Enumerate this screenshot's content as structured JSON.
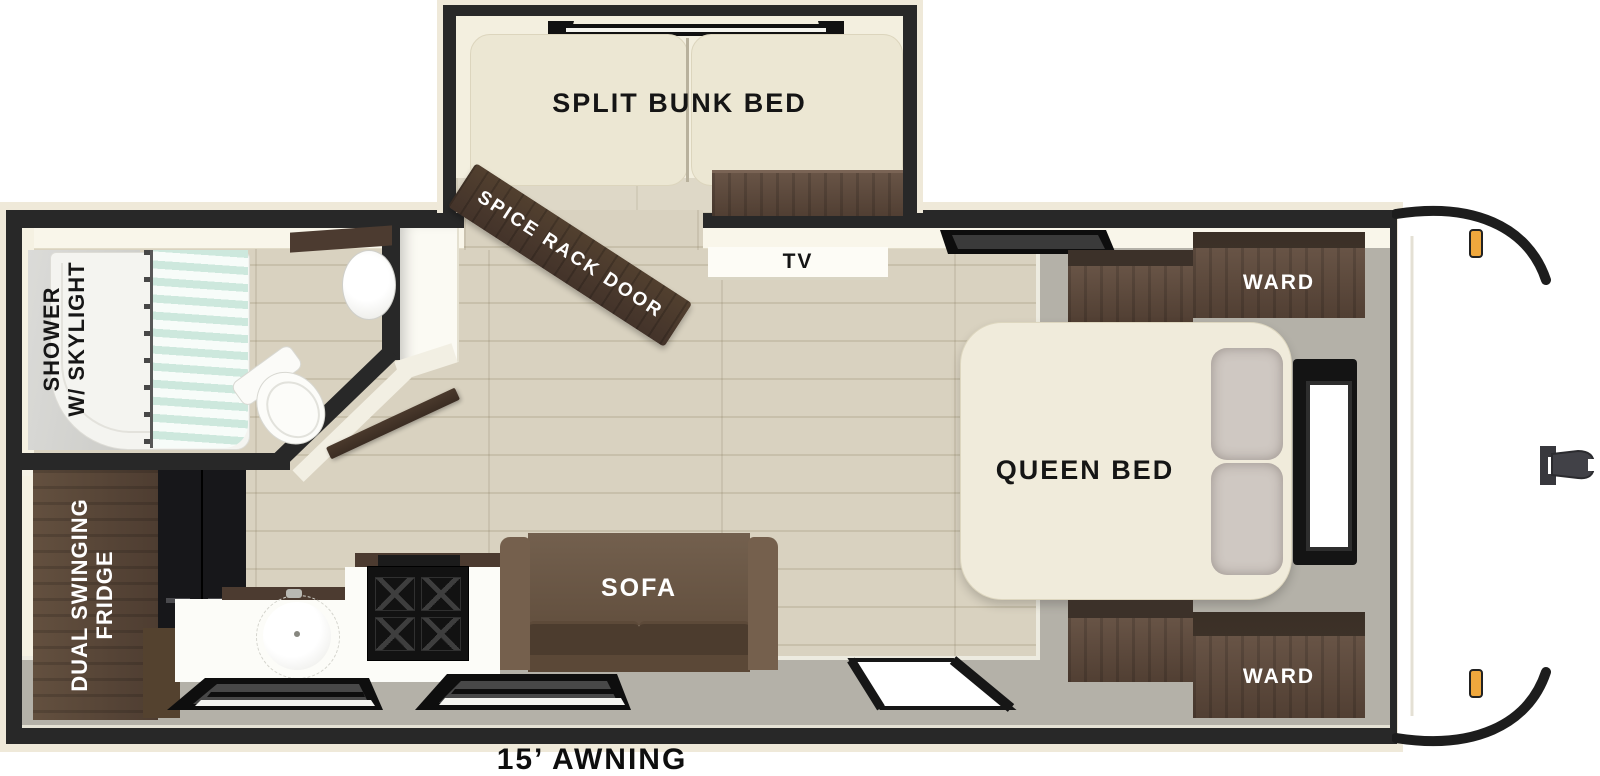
{
  "floorplan": {
    "type": "travel-trailer-floor-plan",
    "labels": {
      "bunk": "SPLIT BUNK BED",
      "spice_rack": "SPICE RACK DOOR",
      "tv": "TV",
      "ward_top": "WARD",
      "ward_bottom": "WARD",
      "queen_bed": "QUEEN BED",
      "sofa": "SOFA",
      "shower_line1": "SHOWER",
      "shower_line2": "W/ SKYLIGHT",
      "fridge_line1": "DUAL SWINGING",
      "fridge_line2": "FRIDGE",
      "awning": "15’ AWNING"
    },
    "colors": {
      "wall_dark": "#282828",
      "exterior_trim_cream": "#efe9d9",
      "wood_floor": "#d9d2c0",
      "platform_gray": "#b4b1a8",
      "cabinet_brown": "#5d4a3d",
      "door_plank_brown": "#4a392e",
      "sofa_brown": "#6b5645",
      "mattress_cream": "#ece7d3",
      "curtain_mint": "#cde8dd",
      "marker_light_orange": "#f0a83d",
      "counter_white": "#fcfcf8",
      "appliance_black": "#151515"
    }
  }
}
